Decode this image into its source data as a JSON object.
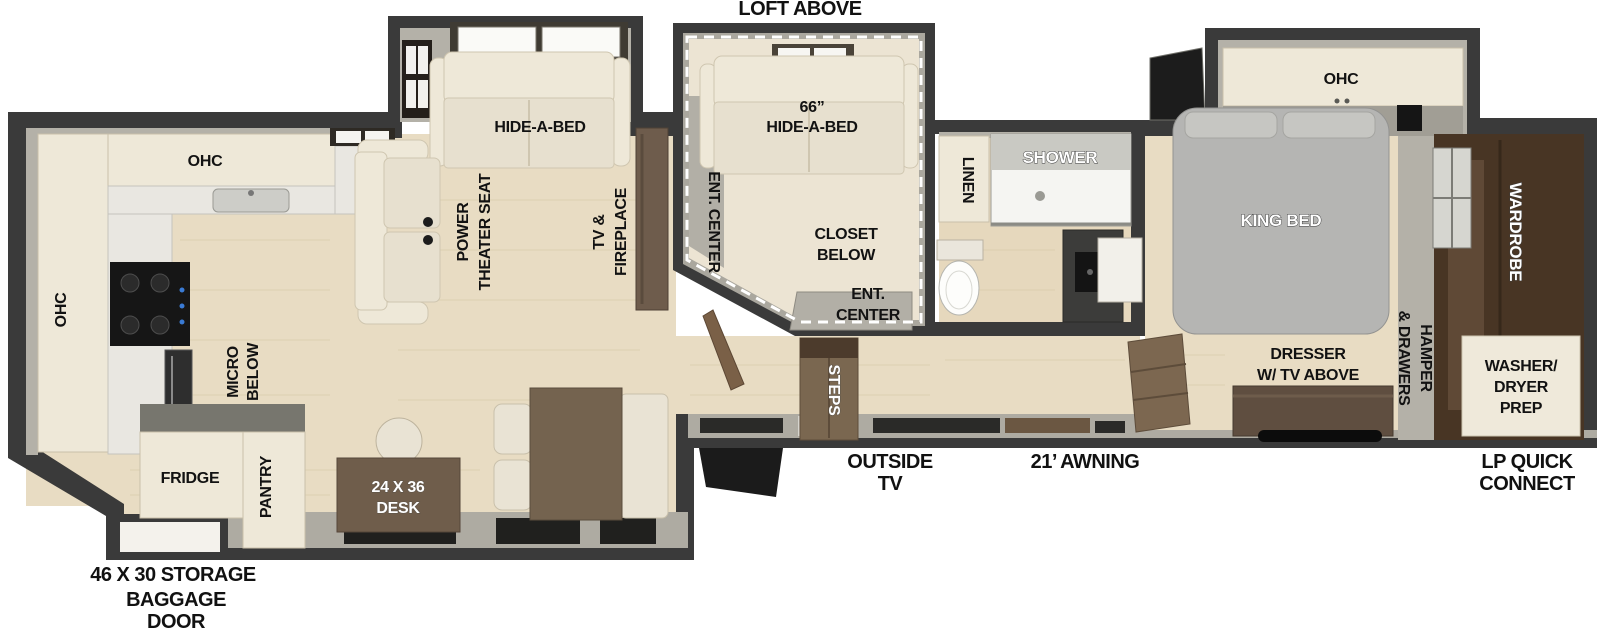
{
  "title": "Fifth-wheel RV floor plan",
  "colors": {
    "wall": "#3a3a3a",
    "lining": "#b4b1a8",
    "floor_wood": "#e8dcc3",
    "loft_floor": "#ece4d3",
    "cabinet_cream": "#eee8d8",
    "sofa_cream": "#e7e0cf",
    "counter_marble": "#e9e7e1",
    "bed_grey": "#b5b5b3",
    "wardrobe_brown": "#483524",
    "furniture_brown": "#6f5d4b",
    "appliance_black": "#161616",
    "label_black": "#121212",
    "label_white": "#ffffff"
  },
  "exterior": {
    "loft_above": "LOFT ABOVE",
    "storage": "46 X 30 STORAGE",
    "baggage_door": [
      "BAGGAGE",
      "DOOR"
    ],
    "outside_tv": [
      "OUTSIDE",
      "TV"
    ],
    "awning": "21’ AWNING",
    "lp_quick_connect": [
      "LP QUICK",
      "CONNECT"
    ]
  },
  "kitchen": {
    "ohc_top": "OHC",
    "ohc_left": "OHC",
    "micro": [
      "MICRO",
      "BELOW"
    ],
    "fridge": "FRIDGE",
    "pantry": "PANTRY",
    "desk": [
      "24 X 36",
      "DESK"
    ]
  },
  "living": {
    "hide_a_bed": "HIDE-A-BED",
    "theater_seat": [
      "POWER",
      "THEATER SEAT"
    ],
    "tv_fireplace": [
      "TV &",
      "FIREPLACE"
    ]
  },
  "loft": {
    "hide_a_bed": [
      "66”",
      "HIDE-A-BED"
    ],
    "ent_center_side": "ENT. CENTER",
    "closet_below": [
      "CLOSET",
      "BELOW"
    ],
    "ent_center_bottom": [
      "ENT.",
      "CENTER"
    ]
  },
  "entry": {
    "steps": "STEPS"
  },
  "bathroom": {
    "linen": "LINEN",
    "shower": "SHOWER"
  },
  "bedroom": {
    "ohc": "OHC",
    "king_bed": "KING BED",
    "wardrobe": "WARDROBE",
    "dresser": [
      "DRESSER",
      "W/ TV ABOVE"
    ],
    "hamper": [
      "HAMPER",
      "& DRAWERS"
    ],
    "washer_dryer": [
      "WASHER/",
      "DRYER",
      "PREP"
    ]
  }
}
